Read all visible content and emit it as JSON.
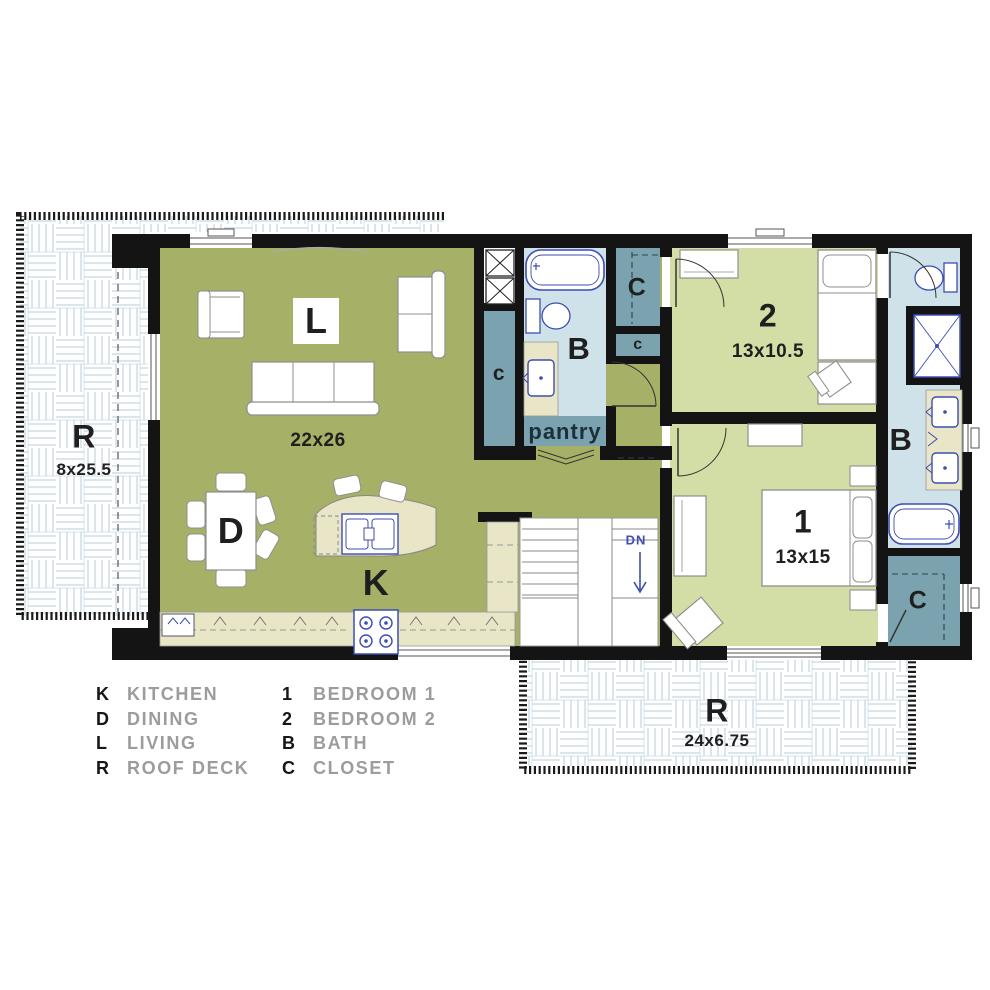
{
  "plan": {
    "living": {
      "label": "L",
      "dim": "22x26"
    },
    "dining": {
      "label": "D"
    },
    "kitchen": {
      "label": "K"
    },
    "pantry": {
      "label": "pantry"
    },
    "stairs": {
      "label": "DN"
    },
    "roof_deck_left": {
      "label": "R",
      "dim": "8x25.5"
    },
    "roof_deck_bottom": {
      "label": "R",
      "dim": "24x6.75"
    },
    "bedroom_2": {
      "label": "2",
      "dim": "13x10.5"
    },
    "bedroom_1": {
      "label": "1",
      "dim": "13x15"
    },
    "bath_middle": {
      "label": "B"
    },
    "bath_right": {
      "label": "B"
    },
    "closet_hall": {
      "label": "c"
    },
    "closet_top": {
      "label": "C"
    },
    "closet_small": {
      "label": "c"
    },
    "closet_bedroom1": {
      "label": "C"
    }
  },
  "legend": {
    "left": [
      {
        "key": "K",
        "label": "KITCHEN"
      },
      {
        "key": "D",
        "label": "DINING"
      },
      {
        "key": "L",
        "label": "LIVING"
      },
      {
        "key": "R",
        "label": "ROOF DECK"
      }
    ],
    "right": [
      {
        "key": "1",
        "label": "BEDROOM 1"
      },
      {
        "key": "2",
        "label": "BEDROOM 2"
      },
      {
        "key": "B",
        "label": "BATH"
      },
      {
        "key": "C",
        "label": "CLOSET"
      }
    ]
  },
  "colors": {
    "living_green": "#a6b066",
    "bedroom_green": "#d3dda6",
    "bath_blue": "#cfe2ea",
    "closet_teal": "#7ba3af",
    "counter_beige": "#e9e5c7",
    "wall_black": "#141414",
    "fixture_navy": "#3d4db0",
    "furniture_gray": "#8f8f8f",
    "deck_line_blue": "#b6cbd8",
    "label_dark": "#1f1f1f",
    "legend_gray": "#9c9c9c"
  }
}
